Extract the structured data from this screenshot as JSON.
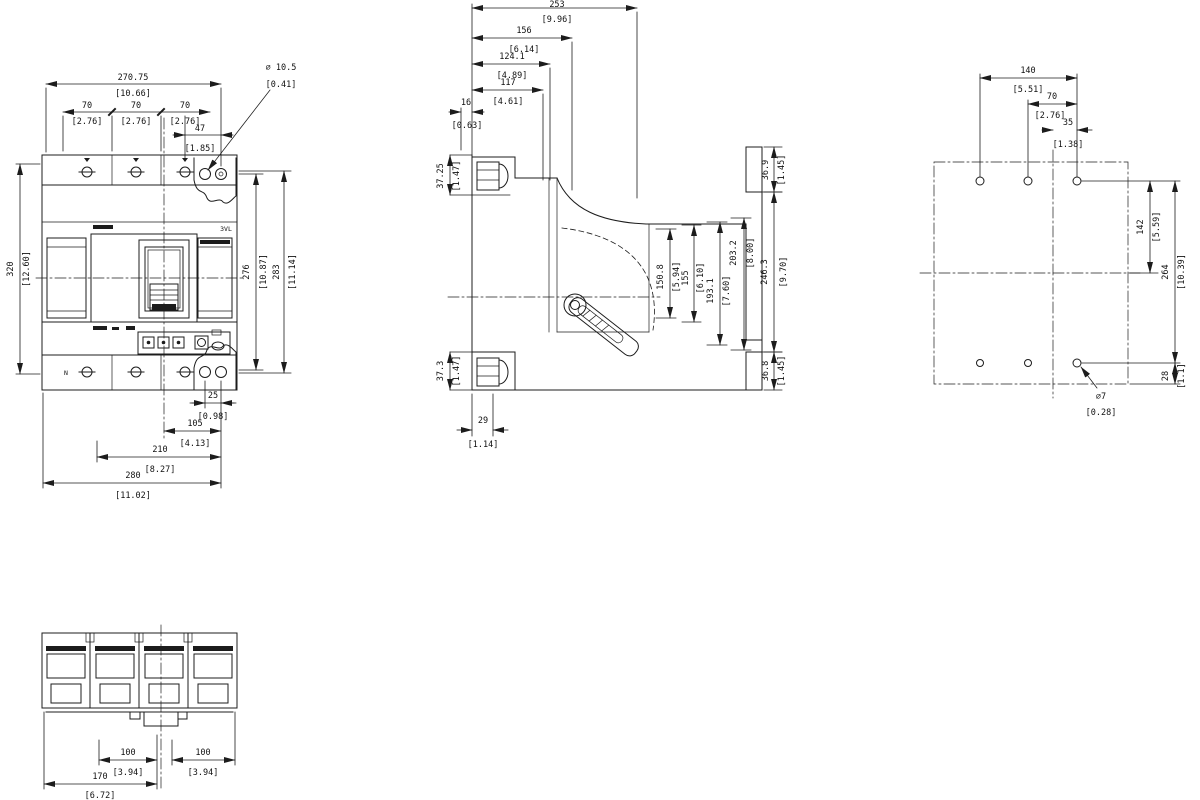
{
  "front": {
    "overall_w": {
      "mm": "270.75",
      "in": "[10.66]"
    },
    "pole_pitch": {
      "mm": "70",
      "in": "[2.76]"
    },
    "hole_dia": {
      "mm": "⌀ 10.5",
      "in": "[0.41]"
    },
    "hole_edge": {
      "mm": "47",
      "in": "[1.85]"
    },
    "height": {
      "mm": "320",
      "in": "[12.60]"
    },
    "h_inner": {
      "mm": "276",
      "in": "[10.87]"
    },
    "h_outer": {
      "mm": "283",
      "in": "[11.14]"
    },
    "b25": {
      "mm": "25",
      "in": "[0.98]"
    },
    "b105": {
      "mm": "105",
      "in": "[4.13]"
    },
    "b210": {
      "mm": "210",
      "in": "[8.27]"
    },
    "b280": {
      "mm": "280",
      "in": "[11.02]"
    },
    "product_label": "3VL",
    "pole_label": "N"
  },
  "side": {
    "d253": {
      "mm": "253",
      "in": "[9.96]"
    },
    "d156": {
      "mm": "156",
      "in": "[6.14]"
    },
    "d124": {
      "mm": "124.1",
      "in": "[4.89]"
    },
    "d117": {
      "mm": "117",
      "in": "[4.61]"
    },
    "d16": {
      "mm": "16",
      "in": "[0.63]"
    },
    "d3725": {
      "mm": "37.25",
      "in": "[1.47]"
    },
    "d373": {
      "mm": "37.3",
      "in": "[1.47]"
    },
    "d29": {
      "mm": "29",
      "in": "[1.14]"
    },
    "d1508": {
      "mm": "150.8",
      "in": "[5.94]"
    },
    "d155": {
      "mm": "155",
      "in": "[6.10]"
    },
    "d1931": {
      "mm": "193.1",
      "in": "[7.60]"
    },
    "d2032": {
      "mm": "203.2",
      "in": "[8.00]"
    },
    "d2463": {
      "mm": "246.3",
      "in": "[9.70]"
    },
    "d369": {
      "mm": "36.9",
      "in": "[1.45]"
    },
    "d368": {
      "mm": "36.8",
      "in": "[1.45]"
    }
  },
  "rear": {
    "d140": {
      "mm": "140",
      "in": "[5.51]"
    },
    "d70": {
      "mm": "70",
      "in": "[2.76]"
    },
    "d35": {
      "mm": "35",
      "in": "[1.38]"
    },
    "d142": {
      "mm": "142",
      "in": "[5.59]"
    },
    "d264": {
      "mm": "264",
      "in": "[10.39]"
    },
    "d28": {
      "mm": "28",
      "in": "[1.1]"
    },
    "hole": {
      "mm": "⌀7",
      "in": "[0.28]"
    }
  },
  "bottom": {
    "d100": {
      "mm": "100",
      "in": "[3.94]"
    },
    "d170": {
      "mm": "170",
      "in": "[6.72]"
    }
  }
}
